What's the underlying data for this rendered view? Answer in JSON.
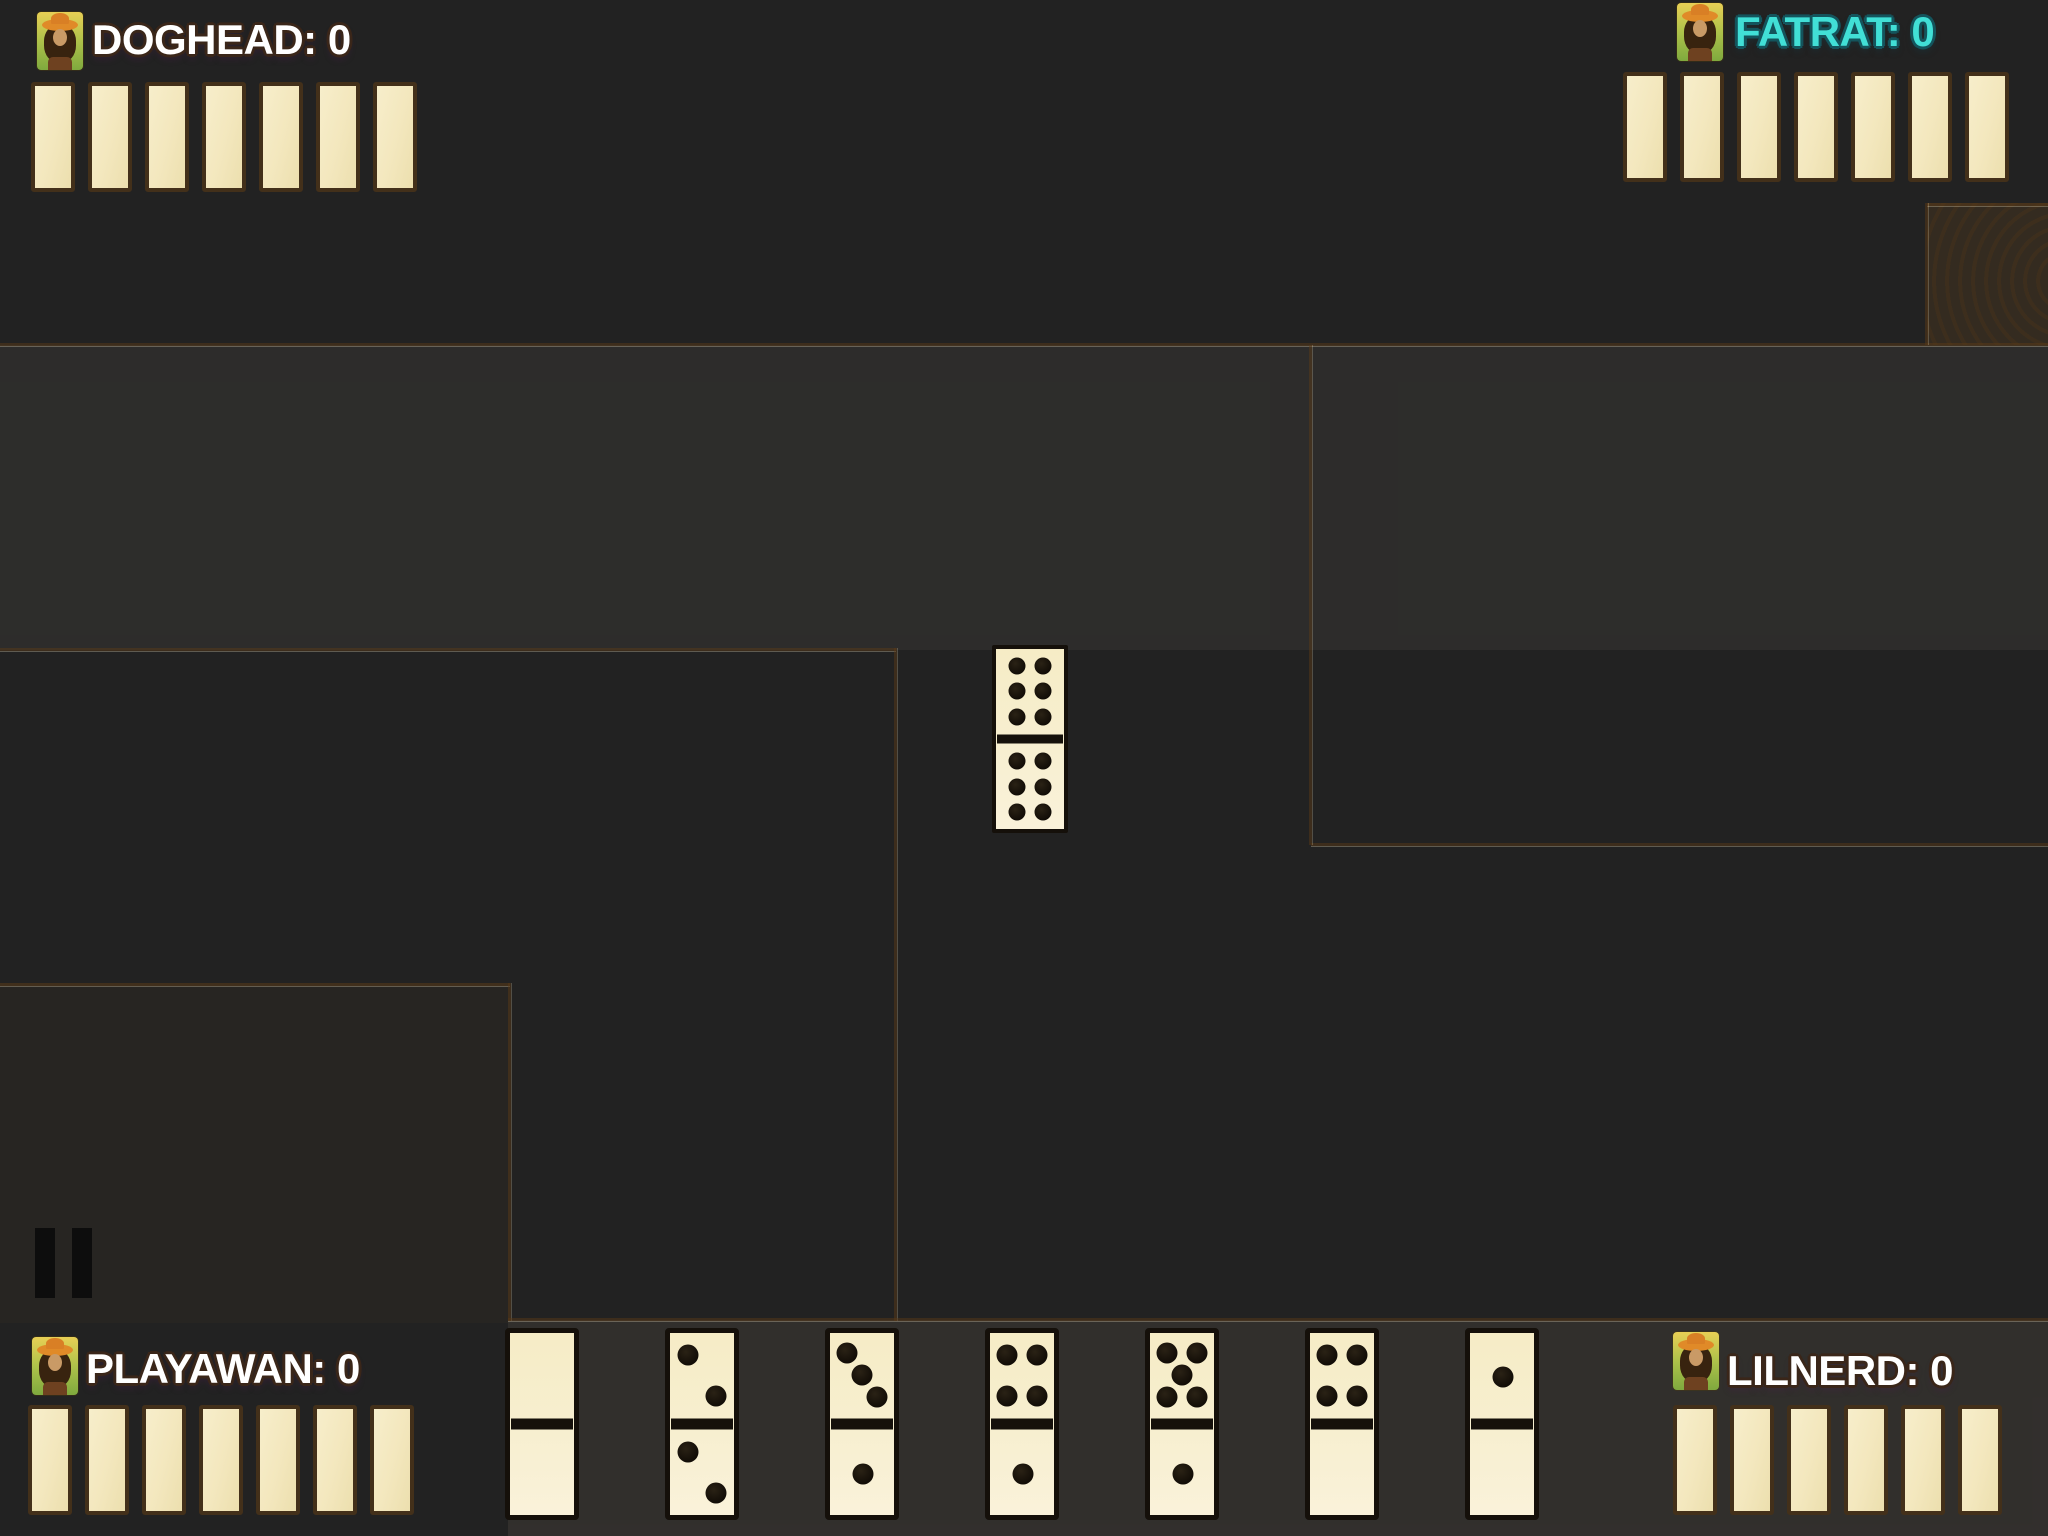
{
  "game": {
    "title": "Dominoes table",
    "colors": {
      "wood_base": "#cfa267",
      "domino_fill": "#f6ecc6",
      "domino_border": "#15100a",
      "facedown_tile_fill": "#f4e9c3",
      "facedown_tile_border": "#43301a",
      "player_name_default": "#ffffff",
      "player_name_fatrat": "#41dfd6",
      "pause_icon_color": "#0d0d0d"
    }
  },
  "players": {
    "top_left": {
      "name": "DOGHEAD",
      "score": "0",
      "label": "DOGHEAD: 0",
      "tile_count": 7
    },
    "top_right": {
      "name": "FATRAT",
      "score": "0",
      "label": "FATRAT: 0",
      "tile_count": 7
    },
    "bottom_left": {
      "name": "PLAYAWAN",
      "score": "0",
      "label": "PLAYAWAN: 0",
      "tile_count": 7
    },
    "bottom_right": {
      "name": "LILNERD",
      "score": "0",
      "label": "LILNERD: 0",
      "tile_count": 6
    }
  },
  "board": {
    "played_dominoes": [
      {
        "top": 6,
        "bottom": 6,
        "orientation": "vertical"
      }
    ]
  },
  "hand": {
    "dominoes": [
      {
        "top": 0,
        "bottom": 0
      },
      {
        "top": 2,
        "bottom": 2
      },
      {
        "top": 3,
        "bottom": 1
      },
      {
        "top": 4,
        "bottom": 1
      },
      {
        "top": 5,
        "bottom": 1
      },
      {
        "top": 4,
        "bottom": 0
      },
      {
        "top": 1,
        "bottom": 0
      }
    ]
  },
  "controls": {
    "pause": "pause-icon"
  }
}
